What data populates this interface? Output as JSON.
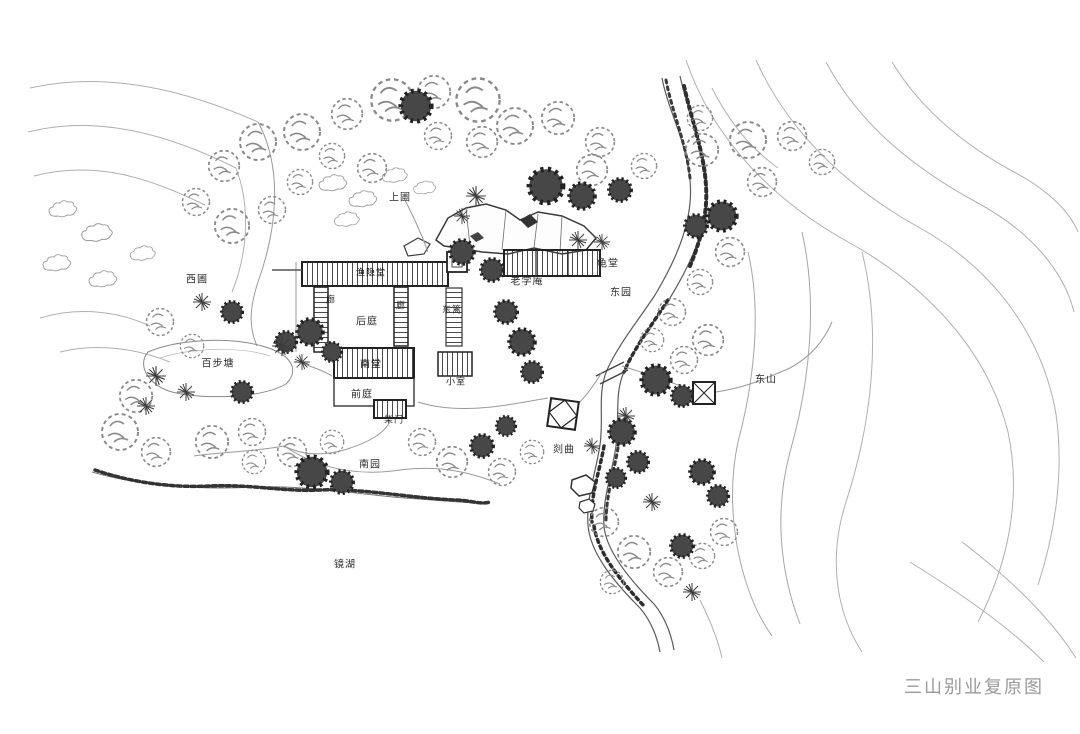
{
  "caption": "三山别业复原图",
  "plan": {
    "labels": {
      "shangpu": "上圃",
      "xipu": "西圃",
      "yuyintang": "渔隐堂",
      "lang_left": "廊",
      "lang_right": "廊",
      "houting": "后庭",
      "dongli": "东篱",
      "laoxuean": "老学庵",
      "guitang": "龟堂",
      "dongyuan": "东园",
      "baibutang": "百步塘",
      "nantang": "南堂",
      "xiaoshi": "小室",
      "qianting": "前庭",
      "chaimen": "柴门",
      "nanyuan": "南园",
      "shanqu": "剡曲",
      "jinghu": "镜湖",
      "dongshan": "东山"
    }
  },
  "colors": {
    "ink": "#2b2b2b",
    "pencil": "#8a8a8a",
    "caption_gray": "#9a9a9a"
  }
}
